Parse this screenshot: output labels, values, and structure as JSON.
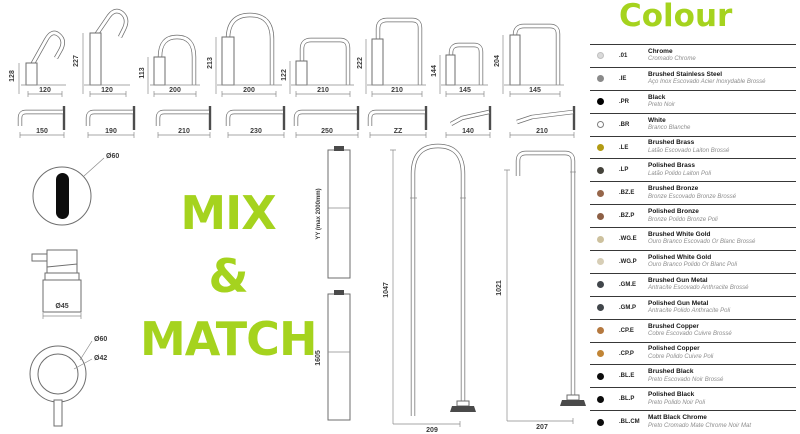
{
  "theme": {
    "accent": "#a5d31e",
    "drawing_line": "#6e6e6e"
  },
  "headline": {
    "line1": "MIX",
    "line2": "&",
    "line3": "MATCH"
  },
  "spouts_top": [
    {
      "height": "128",
      "width": "120"
    },
    {
      "height": "227",
      "width": "120"
    },
    {
      "height": "113",
      "width": "200"
    },
    {
      "height": "213",
      "width": "200"
    },
    {
      "height": "122",
      "width": "210"
    },
    {
      "height": "222",
      "width": "210"
    },
    {
      "height": "144",
      "width": "145"
    },
    {
      "height": "204",
      "width": "145"
    }
  ],
  "spouts_wall": [
    {
      "width": "150"
    },
    {
      "width": "190"
    },
    {
      "width": "210"
    },
    {
      "width": "230"
    },
    {
      "width": "250"
    },
    {
      "width": "ZZ"
    },
    {
      "width": "140"
    },
    {
      "width": "210"
    }
  ],
  "fixtures": {
    "sensor_diameter": "Ø60",
    "joystick_diameter": "Ø45",
    "handle_outer_diameter": "Ø60",
    "handle_inner_diameter": "Ø42"
  },
  "columns": {
    "riser_label": "YY (max 2000mm)",
    "riser2_height": "1605",
    "col1_height": "1047",
    "col1_width": "209",
    "col2_height": "1021",
    "col2_width": "207"
  },
  "colour_panel": {
    "title": "Colour",
    "finishes": [
      {
        "code": ".01",
        "name": "Chrome",
        "subname": "Cromado Chrome",
        "dot": "#d9d9d9",
        "dot_border": "#c0c0c0"
      },
      {
        "code": ".IE",
        "name": "Brushed Stainless Steel",
        "subname": "Aço Inox Escovado Acier Inoxydable Brossé",
        "dot": "#8a8a8a"
      },
      {
        "code": ".PR",
        "name": "Black",
        "subname": "Preto Noir",
        "dot": "#000000"
      },
      {
        "code": ".BR",
        "name": "White",
        "subname": "Branco Blanche",
        "dot": "#ffffff",
        "dot_border": "#7e7e7e"
      },
      {
        "code": ".LE",
        "name": "Brushed Brass",
        "subname": "Latão Escovado Laiton Brossé",
        "dot": "#b29b13"
      },
      {
        "code": ".LP",
        "name": "Polished Brass",
        "subname": "Latão Polido Laiton Poli",
        "dot": "#45433b"
      },
      {
        "code": ".BZ.E",
        "name": "Brushed Bronze",
        "subname": "Bronze Escovado Bronze Brossé",
        "dot": "#96664a"
      },
      {
        "code": ".BZ.P",
        "name": "Polished Bronze",
        "subname": "Bronze Polido Bronze Poli",
        "dot": "#8d5f45"
      },
      {
        "code": ".WG.E",
        "name": "Brushed White Gold",
        "subname": "Ouro Branco Escovado Or Blanc Brossé",
        "dot": "#cdc19e"
      },
      {
        "code": ".WG.P",
        "name": "Polished White Gold",
        "subname": "Ouro Branco Polido Or Blanc Poli",
        "dot": "#d7ceb6"
      },
      {
        "code": ".GM.E",
        "name": "Brushed Gun Metal",
        "subname": "Antracite Escovado Anthracite Brossé",
        "dot": "#41464b"
      },
      {
        "code": ".GM.P",
        "name": "Polished Gun Metal",
        "subname": "Antracite Polido Anthracite Poli",
        "dot": "#41464b"
      },
      {
        "code": ".CP.E",
        "name": "Brushed Copper",
        "subname": "Cobre Escovado Cuivre Brossé",
        "dot": "#b5793f"
      },
      {
        "code": ".CP.P",
        "name": "Polished Copper",
        "subname": "Cobre Polido Cuivre Poli",
        "dot": "#c18536"
      },
      {
        "code": ".BL.E",
        "name": "Brushed Black",
        "subname": "Preto Escovado Noir Brossé",
        "dot": "#0c0c0c"
      },
      {
        "code": ".BL.P",
        "name": "Polished Black",
        "subname": "Preto Polido Noir Poli",
        "dot": "#0c0c0c"
      },
      {
        "code": ".BL.CM",
        "name": "Matt Black Chrome",
        "subname": "Preto Cromado Mate Chrome Noir Mat",
        "dot": "#0c0c0c"
      }
    ]
  }
}
